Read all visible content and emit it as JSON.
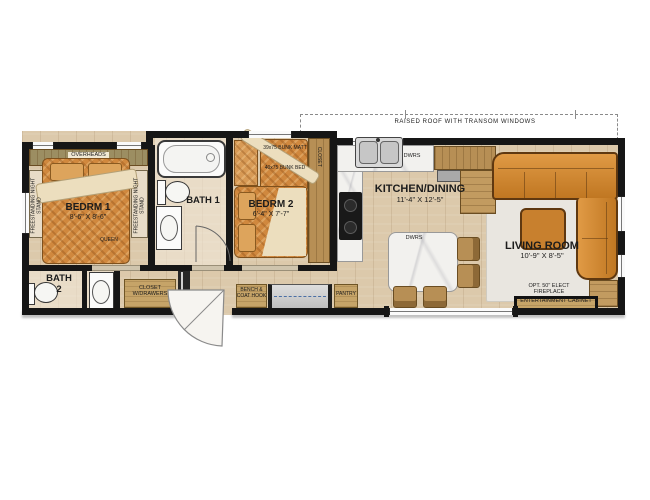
{
  "annotations": {
    "raised_roof": "RAISED ROOF WITH TRANSOM WINDOWS"
  },
  "rooms": {
    "bedroom1": {
      "name": "BEDRM 1",
      "dims": "8'-6\" X 8'-6\"",
      "bed": "QUEEN",
      "overheads": "OVERHEADS",
      "nightstand": "FREESTANDING NIGHT STAND"
    },
    "bath1": {
      "name": "BATH 1"
    },
    "bedroom2": {
      "name": "BEDRM 2",
      "dims": "6'-4\" X 7'-7\"",
      "bunk_mattress": "39x75 BUNK MATT",
      "bunk_bed": "40x75 BUNK BED",
      "closet": "CLOSET"
    },
    "bath2": {
      "name": "BATH 2"
    },
    "kitchen": {
      "name": "KITCHEN/DINING",
      "dims": "11'-4\" X 12'-5\"",
      "drawers": "DWRS"
    },
    "living": {
      "name": "LIVING ROOM",
      "dims": "10'-9\" X 8'-5\"",
      "fireplace_note": "OPT. 50\" ELECT FIREPLACE",
      "entertainment": "ENTERTAINMENT CABINET"
    },
    "hall": {
      "closet": "CLOSET W/DRAWERS",
      "bench": "BENCH & COAT HOOK",
      "pantry": "PANTRY"
    }
  },
  "colors": {
    "wall": "#161616",
    "floor_wood": "#dcc9ab",
    "furniture_orange": "#d0883e",
    "cabinet_tan": "#c6a468",
    "marble": "#f2f1ee",
    "rug": "#e9e6e0",
    "glass_dash": "#4a6fa5"
  }
}
